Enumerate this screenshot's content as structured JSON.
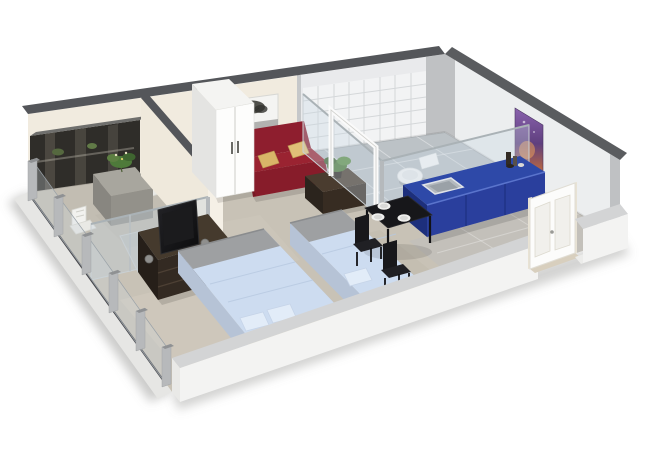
{
  "scene": {
    "kind": "isometric-3d-floor-plan",
    "description": "3D cutaway floor plan render of a studio apartment",
    "background": "#ffffff"
  },
  "rooms": [
    {
      "name": "balcony",
      "features": [
        "mirror-wall",
        "outdoor-table",
        "outdoor-chairs",
        "plant",
        "glass-partition"
      ]
    },
    {
      "name": "living-sleeping-area",
      "features": [
        "wardrobe",
        "sofa",
        "coffee-table",
        "tv-stand",
        "double-bed",
        "single-bed",
        "tree-wall-art"
      ]
    },
    {
      "name": "bathroom",
      "features": [
        "tiled-shower-wall",
        "toilet",
        "glass-walls",
        "shower-door-frame"
      ]
    },
    {
      "name": "kitchen",
      "features": [
        "blue-counter",
        "sink",
        "counter-items"
      ]
    },
    {
      "name": "dining-entry",
      "features": [
        "dining-table",
        "dining-chairs",
        "plates",
        "entrance-door",
        "tile-floor"
      ]
    }
  ],
  "furniture": {
    "wardrobe": "two-door white wardrobe",
    "sofa": "dark red futon sofa with two gold pillows",
    "coffee_table": "dark brown coffee table with plant",
    "tv_stand": "dark brown media cabinet with television",
    "double_bed": "double bed, light blue duvet, two pillows",
    "single_bed": "single bed, light blue duvet, one pillow",
    "dining_table": "black dining table with three place settings",
    "kitchen_counter": "blue kitchen base cabinets with sink",
    "toilet": "white toilet",
    "balcony_table": "stone bistro table with plant",
    "balcony_chairs": "white slatted outdoor chairs",
    "door": "white panelled entrance door"
  },
  "colors": {
    "background": "#ffffff",
    "wall_top": "#54565a",
    "wall_cream": "#f1ebdf",
    "wall_light": "#e9eaec",
    "wall_right": "#eceeef",
    "partition_cream": "#efe9dc",
    "pilaster_gray": "#bfc1c3",
    "floor_concrete": "#c8c2b6",
    "floor_balcony": "#c2bdb2",
    "floor_tile_bath": "#bcc2c6",
    "floor_tile_entry": "#c3c0ba",
    "mirror_wall": "#2f2d29",
    "sofa_red": "#8e1e2e",
    "sofa_seat_top": "#9a2331",
    "sofa_front": "#871c2a",
    "pillow_gold": "#d9b568",
    "wardrobe_white": "#fdfdfc",
    "wardrobe_side": "#e4e4e2",
    "coffee_table_top": "#4a3c2f",
    "tv_stand_brown": "#332a22",
    "tv_black": "#0f0f10",
    "kitchen_blue_top": "#2e49a8",
    "kitchen_blue_front": "#2a3f9d",
    "kitchen_blue_side": "#1d2f7c",
    "sink_gray": "#b3b9be",
    "bed_duvet": "#cddcf0",
    "bed_pillow": "#e2ecf8",
    "bed_frame_gray": "#9ea0a2",
    "bed_base_beige": "#d9d0b4",
    "bed_side_blue": "#b6c3d6",
    "dining_black": "#17171a",
    "plate_white": "#f0f0ee",
    "glass_tint": "rgba(200,215,225,0.35)",
    "tile_white": "#f2f3f4",
    "art_purple": "#7b53a0",
    "art_purple_dark": "#52346f",
    "art_orange": "#c06a3d",
    "tree_art_bg": "#f4f4f2",
    "tree_dark": "#32322e",
    "door_white": "#fcfcfb",
    "toilet_white": "#f4f5f5",
    "plant_green": "#4e7a3a",
    "stone_table": "#a8a69e",
    "chair_white": "#f2f2ef",
    "window_post": "#b7b9bb",
    "low_wall_face": "#f3f3f2",
    "low_wall_top": "#d3d4d5"
  }
}
